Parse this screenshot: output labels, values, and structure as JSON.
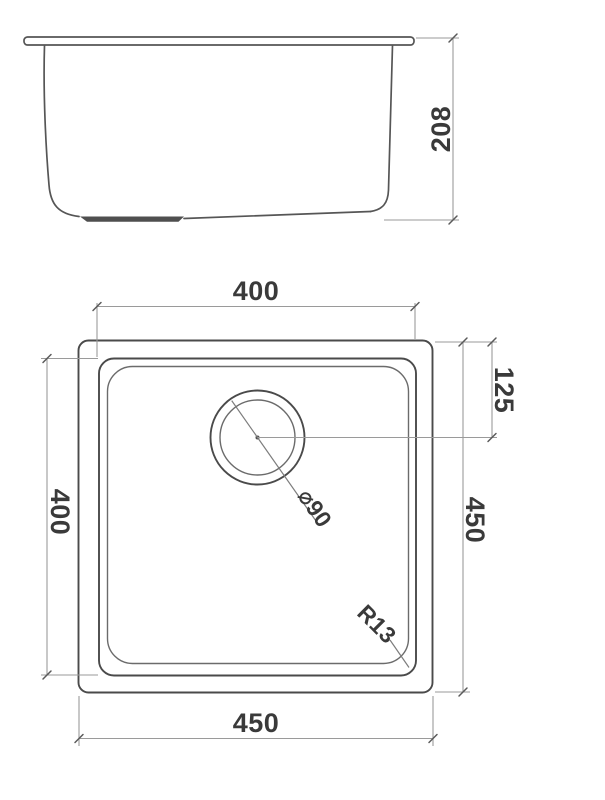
{
  "colors": {
    "line": "#4a4a4a",
    "dim": "#9a9a9a",
    "tick": "#5a5a5a",
    "text": "#3a3a3a",
    "bg": "#ffffff"
  },
  "drawing": {
    "elevation": {
      "depth_label": "208"
    },
    "plan": {
      "top_width_label": "400",
      "left_height_label": "400",
      "drain_offset_label": "125",
      "right_height_label": "450",
      "bottom_width_label": "450",
      "drain_diameter_label": "⌀90",
      "corner_radius_label": "R13"
    }
  }
}
